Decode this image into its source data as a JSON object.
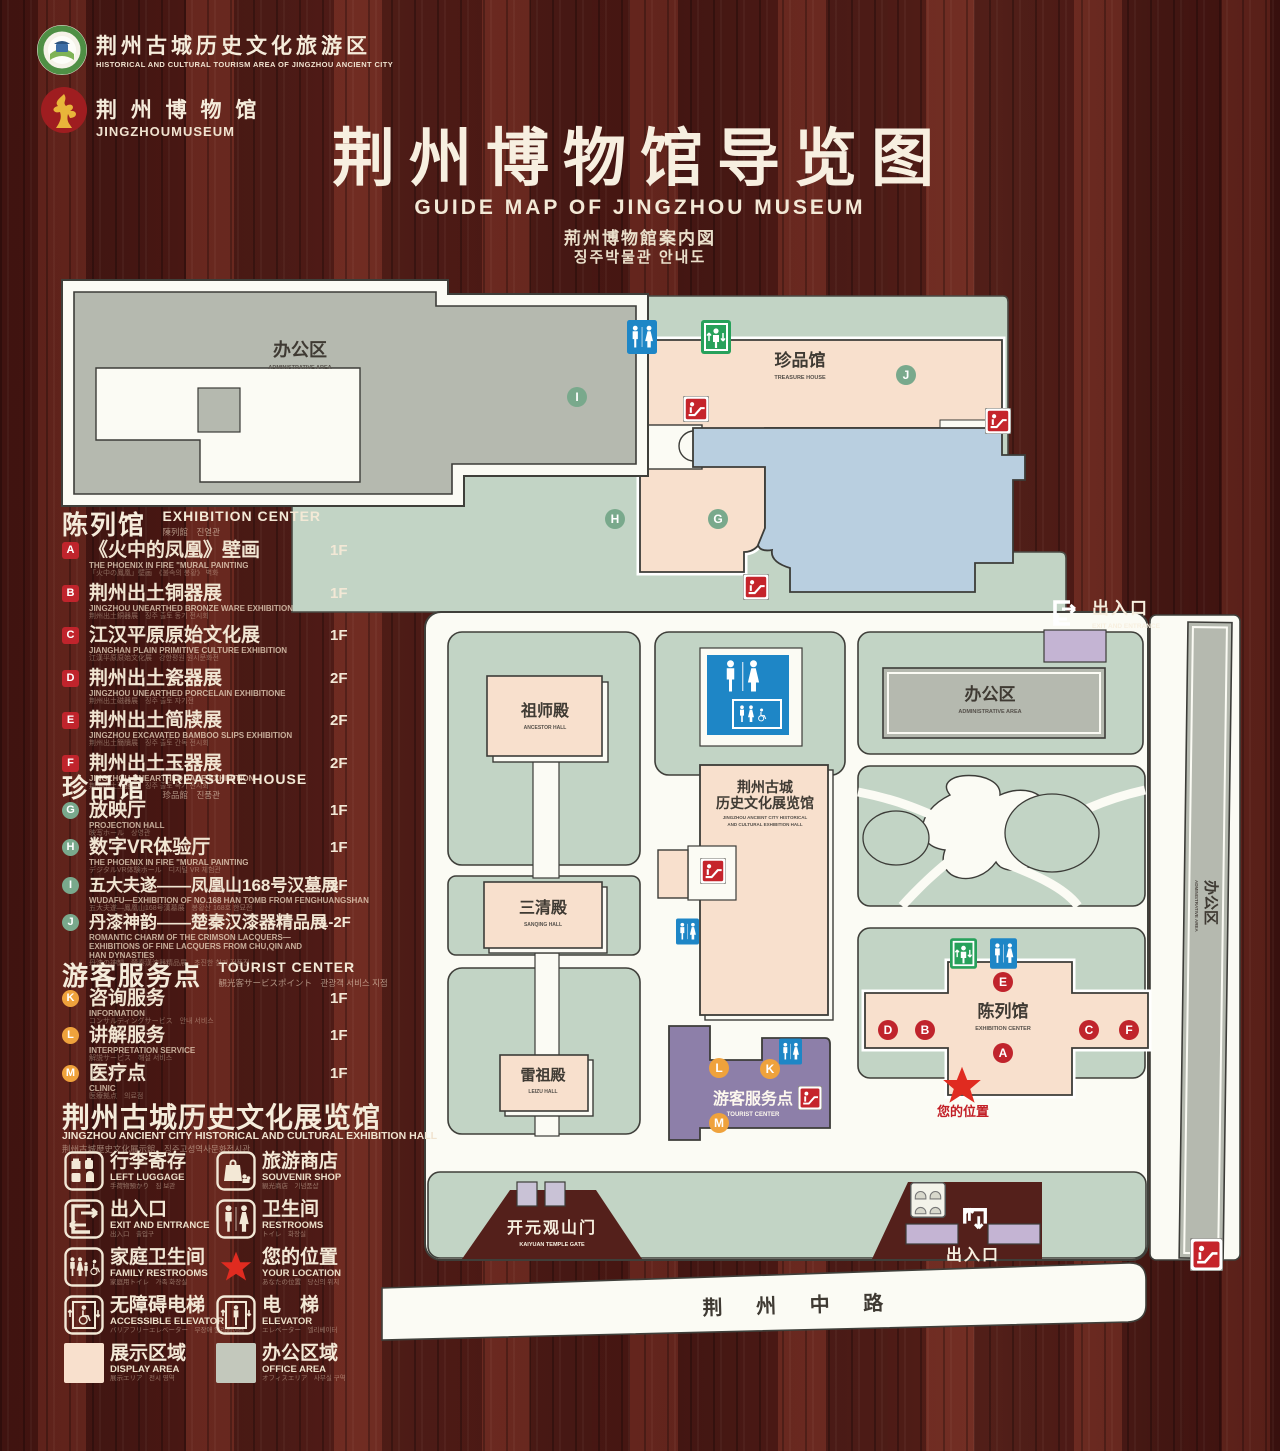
{
  "header": {
    "logo1_zh": "荆州古城历史文化旅游区",
    "logo1_en": "HISTORICAL AND CULTURAL TOURISM AREA OF JINGZHOU ANCIENT CITY",
    "logo2_zh": "荆 州 博 物 馆",
    "logo2_en": "JINGZHOUMUSEUM",
    "title_zh": "荆州博物馆导览图",
    "title_en": "GUIDE MAP OF JINGZHOU MUSEUM",
    "title_ja": "荊州博物館案内図",
    "title_ko": "징주박물관 안내도"
  },
  "legend": {
    "sections": [
      {
        "title_zh": "陈列馆",
        "title_en": "EXHIBITION CENTER",
        "title_sub": "陳列館　진열관",
        "items": [
          {
            "key": "A",
            "zh": "《火中的凤凰》壁画",
            "en": "THE PHOENIX IN FIRE \"MURAL PAINTING",
            "sub": "「火中の鳳凰」壁画　《불속의 봉황》 벽화",
            "floor": "1F"
          },
          {
            "key": "B",
            "zh": "荆州出土铜器展",
            "en": "JINGZHOU UNEARTHED BRONZE WARE EXHIBITION",
            "sub": "荆州出土銅器展　징주 출토 동기 전시회",
            "floor": "1F"
          },
          {
            "key": "C",
            "zh": "江汉平原原始文化展",
            "en": "JIANGHAN PLAIN PRIMITIVE CULTURE EXHIBITION",
            "sub": "江漢平原原始文化展　강한평원 원시문화전",
            "floor": "1F"
          },
          {
            "key": "D",
            "zh": "荆州出土瓷器展",
            "en": "JINGZHOU UNEARTHED PORCELAIN EXHIBITIONE",
            "sub": "荆州出土磁器展　징주 출토 자기전",
            "floor": "2F"
          },
          {
            "key": "E",
            "zh": "荆州出土简牍展",
            "en": "JINGZHOU EXCAVATED BAMBOO SLIPS EXHIBITION",
            "sub": "荆州出土簡牘展　징주 출토 간독 전시회",
            "floor": "2F"
          },
          {
            "key": "F",
            "zh": "荆州出土玉器展",
            "en": "JINGZHOU UNEARTHED JADE EXHIBITION",
            "sub": "荆州出土玉器展　징주 출토 옥기 전시회",
            "floor": "2F"
          }
        ]
      },
      {
        "title_zh": "珍品馆",
        "title_en": "TREASURE HOUSE",
        "title_sub": "珍品館　진품관",
        "items": [
          {
            "key": "G",
            "zh": "放映厅",
            "en": "PROJECTION HALL",
            "sub": "映写ホール　상영관",
            "floor": "1F"
          },
          {
            "key": "H",
            "zh": "数字VR体验厅",
            "en": "THE PHOENIX IN FIRE \"MURAL PAINTING",
            "sub": "デジタルVR体験ホール　디지털 VR 체험관",
            "floor": "1F"
          },
          {
            "key": "I",
            "zh": "五大夫遂——凤凰山168号汉墓展",
            "en": "WUDAFU—EXHIBITION OF NO.168 HAN TOMB FROM FENGHUANGSHAN",
            "sub": "五大夫遂—鳳凰山168号漢墓展　봉황산 168호 한묘전",
            "floor": "2F"
          },
          {
            "key": "J",
            "zh": "丹漆神韵——楚秦汉漆器精品展",
            "en": "ROMANTIC CHARM OF THE CRIMSON LACQUERS—EXHIBITIONS OF FINE LACQUERS FROM CHU,QIN AND HAN DYNASTIES",
            "sub": "丹漆の神韻—楚秦漢漆器精品展　초진한 칠기 정품전",
            "floor": "1-2F"
          }
        ]
      },
      {
        "title_zh": "游客服务点",
        "title_en": "TOURIST CENTER",
        "title_sub": "観光客サービスポイント　관광객 서비스 지점",
        "items": [
          {
            "key": "K",
            "zh": "咨询服务",
            "en": "INFORMATION",
            "sub": "コンサルティングサービス　안내 서비스",
            "floor": "1F"
          },
          {
            "key": "L",
            "zh": "讲解服务",
            "en": "INTERPRETATION SERVICE",
            "sub": "解説サービス　해설 서비스",
            "floor": "1F"
          },
          {
            "key": "M",
            "zh": "医疗点",
            "en": "CLINIC",
            "sub": "医療拠点　의료점",
            "floor": "1F"
          }
        ]
      }
    ],
    "hall_title": {
      "zh": "荆州古城历史文化展览馆",
      "en": "JINGZHOU ANCIENT CITY HISTORICAL AND CULTURAL EXHIBITION HALL",
      "sub": "荆州古城歴史文化展示館　징주고성역사문화전시관"
    },
    "icons": [
      {
        "zh": "行李寄存",
        "en": "LEFT LUGGAGE",
        "sub": "手荷物預かり　짐 보관"
      },
      {
        "zh": "旅游商店",
        "en": "SOUVENIR SHOP",
        "sub": "観光商店　기념품샵"
      },
      {
        "zh": "出入口",
        "en": "EXIT AND ENTRANCE",
        "sub": "出入口　출입구"
      },
      {
        "zh": "卫生间",
        "en": "RESTROOMS",
        "sub": "トイレ　화장실"
      },
      {
        "zh": "家庭卫生间",
        "en": "FAMILY RESTROOMS",
        "sub": "家庭用トイレ　가족 화장실"
      },
      {
        "zh": "您的位置",
        "en": "YOUR LOCATION",
        "sub": "あなたの位置　당신의 위치"
      },
      {
        "zh": "无障碍电梯",
        "en": "ACCESSIBLE ELEVATOR",
        "sub": "バリアフリーエレベーター　무장애 엘리베이터"
      },
      {
        "zh": "电　梯",
        "en": "ELEVATOR",
        "sub": "エレベーター　엘리베이터"
      },
      {
        "zh": "展示区域",
        "en": "DISPLAY AREA",
        "sub": "展示エリア　전시 영역"
      },
      {
        "zh": "办公区域",
        "en": "OFFICE AREA",
        "sub": "オフィスエリア　사무실 구역"
      }
    ]
  },
  "map": {
    "labels": {
      "admin_top": {
        "zh": "办公区",
        "en": "ADMINISTRATIVE AREA"
      },
      "treasure": {
        "zh": "珍品馆",
        "en": "TREASURE HOUSE"
      },
      "admin_right": {
        "zh": "办公区",
        "en": "ADMINISTRATIVE AREA"
      },
      "admin_strip": {
        "zh": "办公区",
        "en": "ADMINISTRATIVE AREA"
      },
      "ancestor": {
        "zh": "祖师殿",
        "en": "ANCESTOR HALL"
      },
      "sanqing": {
        "zh": "三清殿",
        "en": "SANQING HALL"
      },
      "leizu": {
        "zh": "雷祖殿",
        "en": "LEIZU HALL"
      },
      "hall": {
        "zh1": "荆州古城",
        "zh2": "历史文化展览馆",
        "en1": "JINGZHOU ANCIENT CITY HISTORICAL",
        "en2": "AND CULTURAL EXHIBITION HALL"
      },
      "tourist": {
        "zh": "游客服务点",
        "en": "TOURIST CENTER"
      },
      "exhibition": {
        "zh": "陈列馆",
        "en": "EXHIBITION CENTER"
      },
      "your_location": {
        "zh": "您的位置"
      },
      "exit_top": {
        "zh": "出入口",
        "en": "EXIT AND ENTRANCE"
      },
      "exit_bottom": {
        "zh": "出入口",
        "en": "EXIT AND ENTRANCE"
      },
      "gate": {
        "zh": "开元观山门",
        "en": "KAIYUAN TEMPLE GATE"
      },
      "road": {
        "zh": "荆 州 中 路"
      }
    },
    "colors": {
      "ground_green": "#c2d4c5",
      "building_pink": "#f8e0cd",
      "building_gray": "#b5b9af",
      "water_blue": "#b9cfe0",
      "tourist_purple": "#8d7fa9",
      "gate_purple": "#c4b4d3",
      "path_white": "#fbfbf4",
      "badge_red": "#c0242c",
      "badge_green": "#79a98c",
      "badge_orange": "#efa23c",
      "restroom_blue": "#1e86c6",
      "elevator_green": "#27a15b",
      "escalator_red": "#c5242b",
      "star_red": "#e02b20"
    }
  }
}
